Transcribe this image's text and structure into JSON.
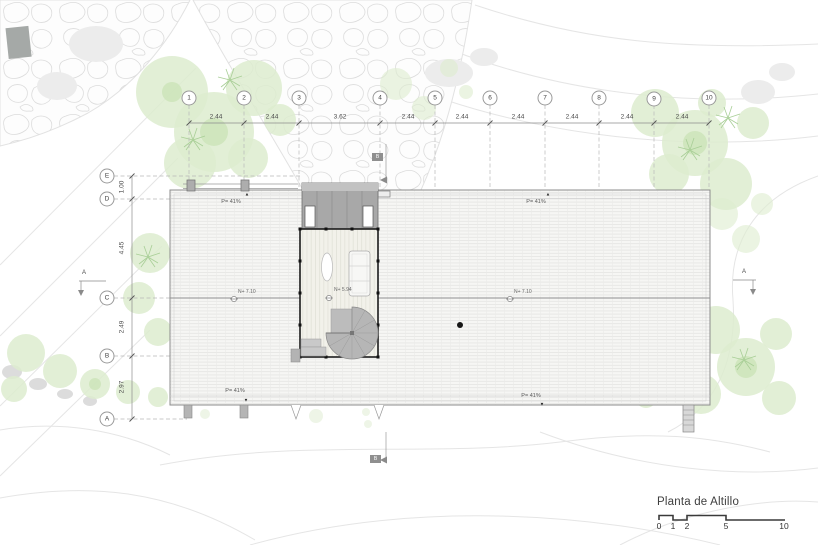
{
  "plan": {
    "title": "Planta de Altillo",
    "scale_labels": [
      "0",
      "1",
      "2",
      "5",
      "10"
    ],
    "grid_columns": [
      "1",
      "2",
      "3",
      "4",
      "5",
      "6",
      "7",
      "8",
      "9",
      "10"
    ],
    "column_spacings": [
      "2.44",
      "2.44",
      "3.62",
      "2.44",
      "2.44",
      "2.44",
      "2.44",
      "2.44",
      "2.44"
    ],
    "grid_rows": [
      "E",
      "D",
      "C",
      "B",
      "A"
    ],
    "row_spacings": [
      "1.00",
      "4.45",
      "2.49",
      "2.97"
    ],
    "labels": {
      "roof_pitch": "P= 41%",
      "roof_level": "N+ 7.10",
      "altillo_level": "N+ 5.94",
      "section_a": "A",
      "section_b": "B"
    },
    "colors": {
      "vegetation": "#ddeccf",
      "roof_dark": "#a8a8a8",
      "contour": "#e5e5e5",
      "ink": "#1c1c1c"
    }
  }
}
